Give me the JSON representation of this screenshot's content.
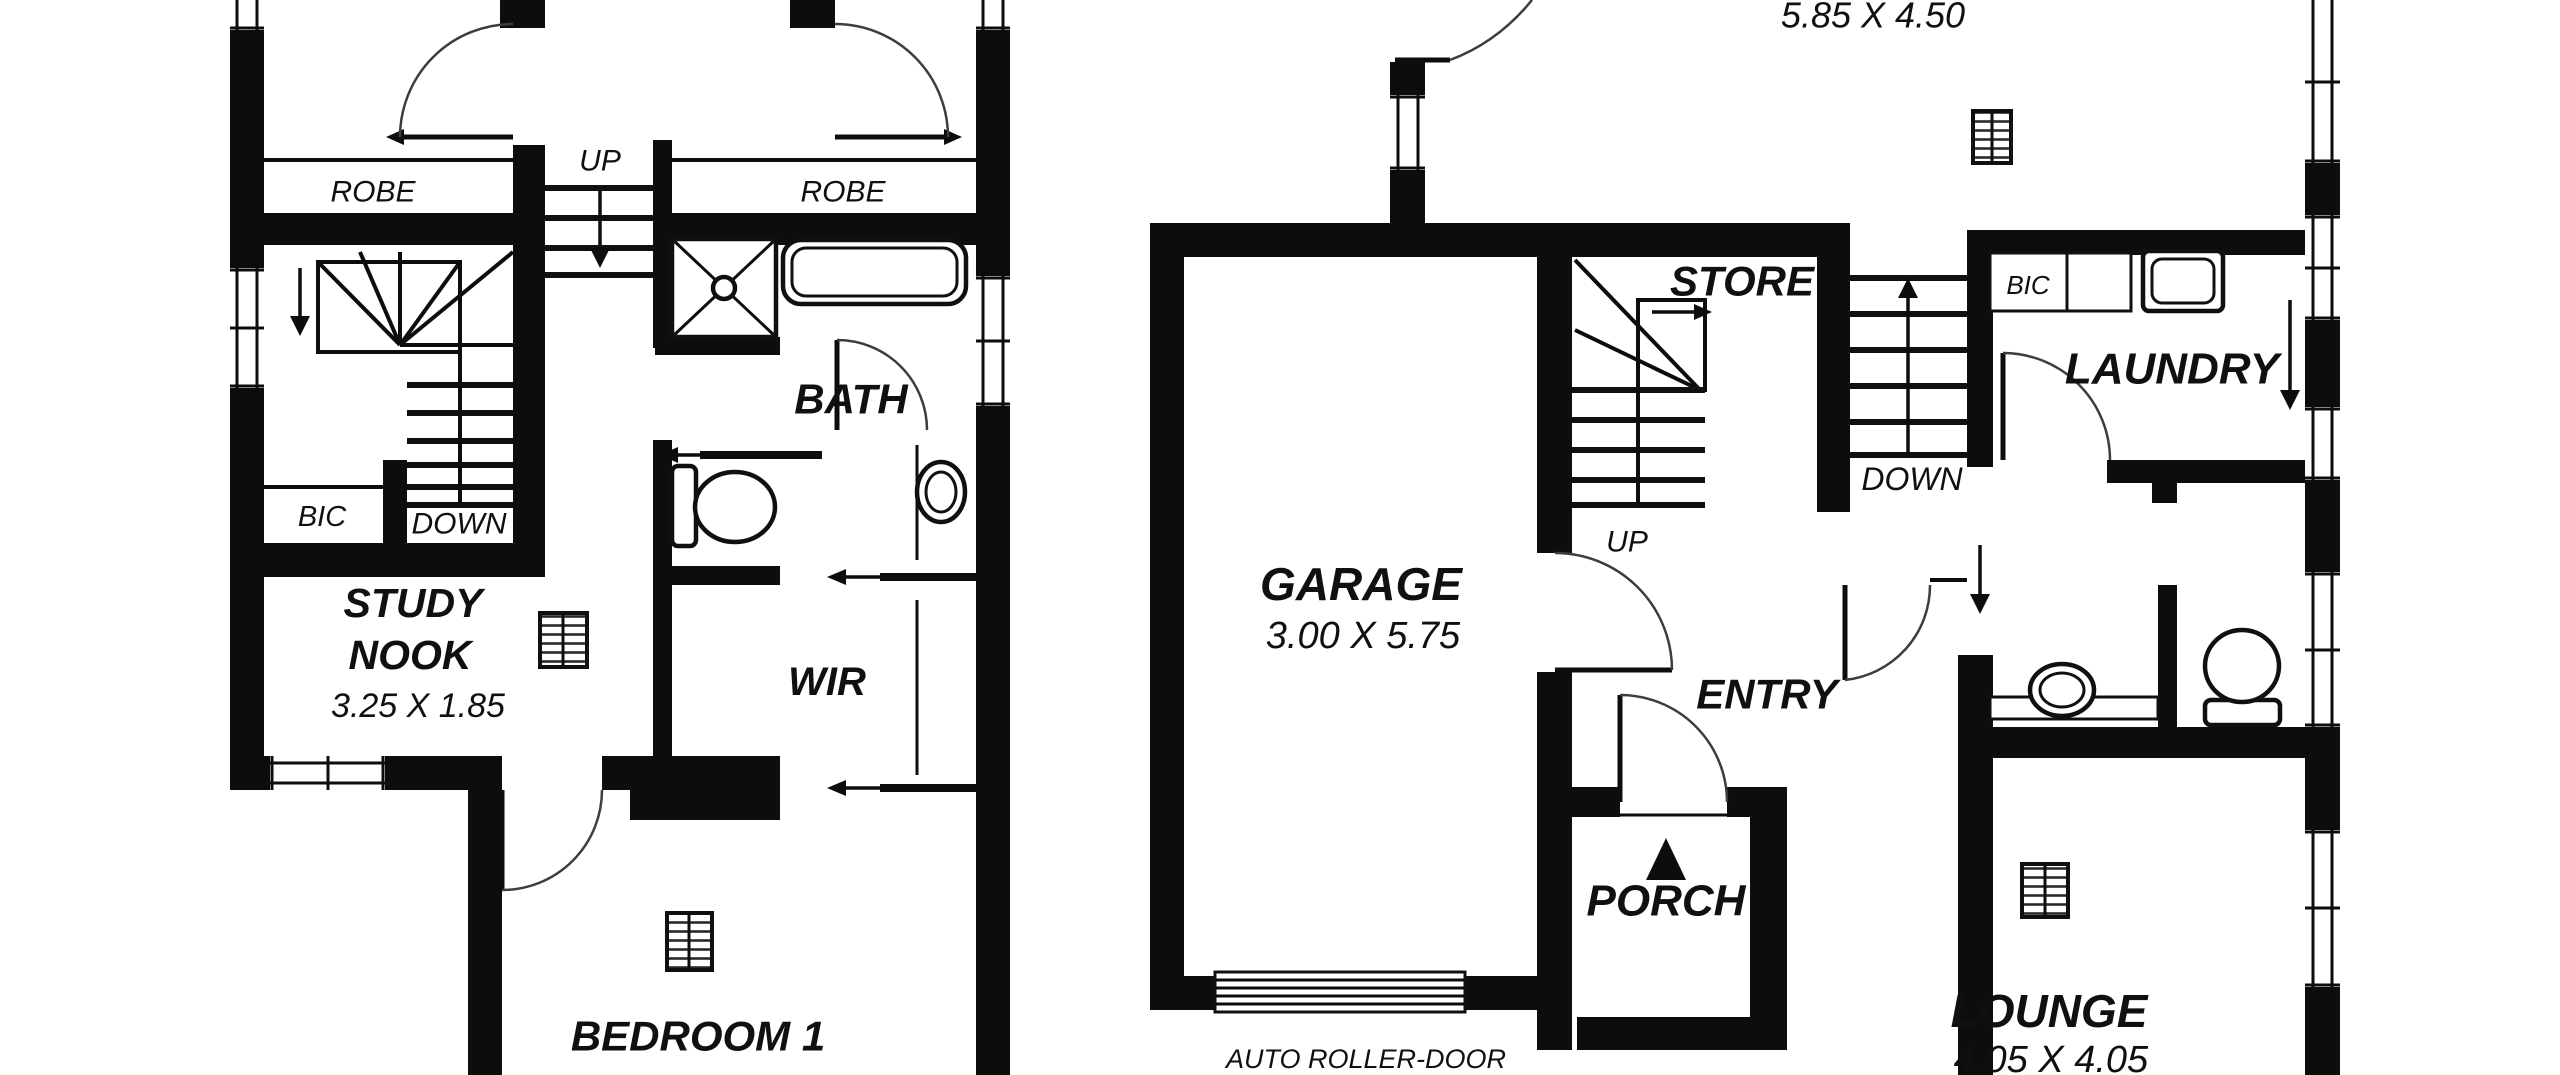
{
  "document": {
    "type": "floor-plan",
    "style": "black-and-white architectural drawing, two plans side by side"
  },
  "colors": {
    "ink": "#0d0d0d",
    "background": "#ffffff",
    "door_arc": "#3d3d3d"
  },
  "first_floor": {
    "robe_left": "ROBE",
    "up": "UP",
    "robe_right": "ROBE",
    "bath": "BATH",
    "bic": "BIC",
    "down": "DOWN",
    "study_line1": "STUDY",
    "study_line2": "NOOK",
    "study_dim": "3.25 X 1.85",
    "wir": "WIR",
    "bedroom1": "BEDROOM 1",
    "bedroom1_dim": "4.05 X 2.50"
  },
  "ground_floor": {
    "top_room_dim": "5.85 X 4.50",
    "garage": "GARAGE",
    "garage_dim": "3.00 X 5.75",
    "store": "STORE",
    "up": "UP",
    "down": "DOWN",
    "entry": "ENTRY",
    "porch": "PORCH",
    "laundry": "LAUNDRY",
    "bic": "BIC",
    "lounge": "LOUNGE",
    "lounge_dim": "4.05 X 4.05",
    "roller_door": "AUTO ROLLER-DOOR"
  },
  "symbols": {
    "vent_squares": 4,
    "door_swings": 9,
    "sliding_doors": 3,
    "stair_flights": 4
  }
}
